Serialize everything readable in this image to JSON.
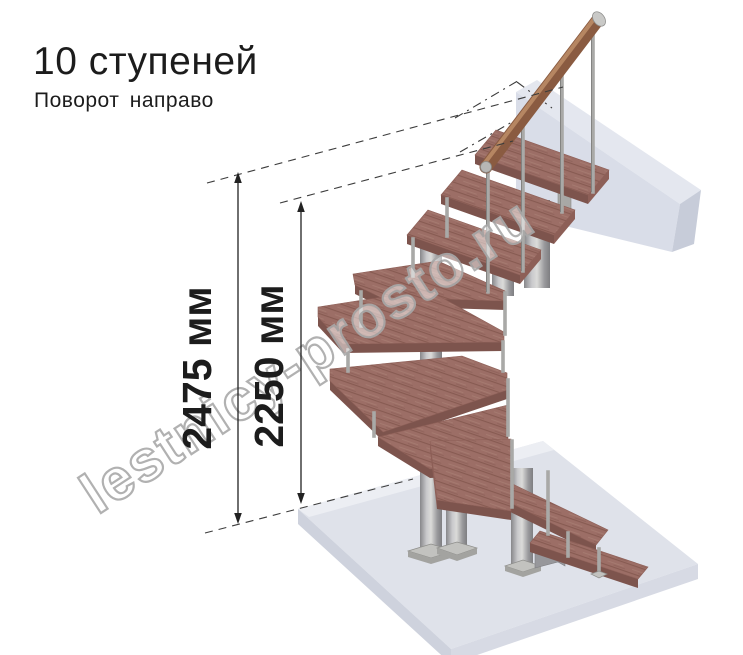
{
  "title": {
    "heading": "10 ступеней",
    "subtitle": "Поворот направо"
  },
  "dimensions": {
    "total_height_label": "2475 мм",
    "upper_height_label": "2250 мм"
  },
  "watermark": {
    "text": "lestnicy-prosto.ru"
  },
  "colors": {
    "text_color": "#1c1c1c",
    "dim_color": "#222222",
    "tread_top": "#9c6e66",
    "tread_streak": "#84584f",
    "tread_light": "#a87d73",
    "tread_front": "#7d544d",
    "tread_side": "#8d5f57",
    "handrail": "#8a5b41",
    "handrail_highlight": "#bd8e69",
    "floor_top": "#dfe2ea",
    "floor_left": "#ced2dd",
    "floor_right": "#d7dae4",
    "floor_bevel": "#eceef3",
    "beam_top": "#e4e7ef",
    "beam_front": "#d9dde8",
    "beam_end": "#c7ccd9",
    "metal_light": "#d8d8d6",
    "metal_dark": "#85858a",
    "watermark_gray": "#a9a9a9"
  }
}
